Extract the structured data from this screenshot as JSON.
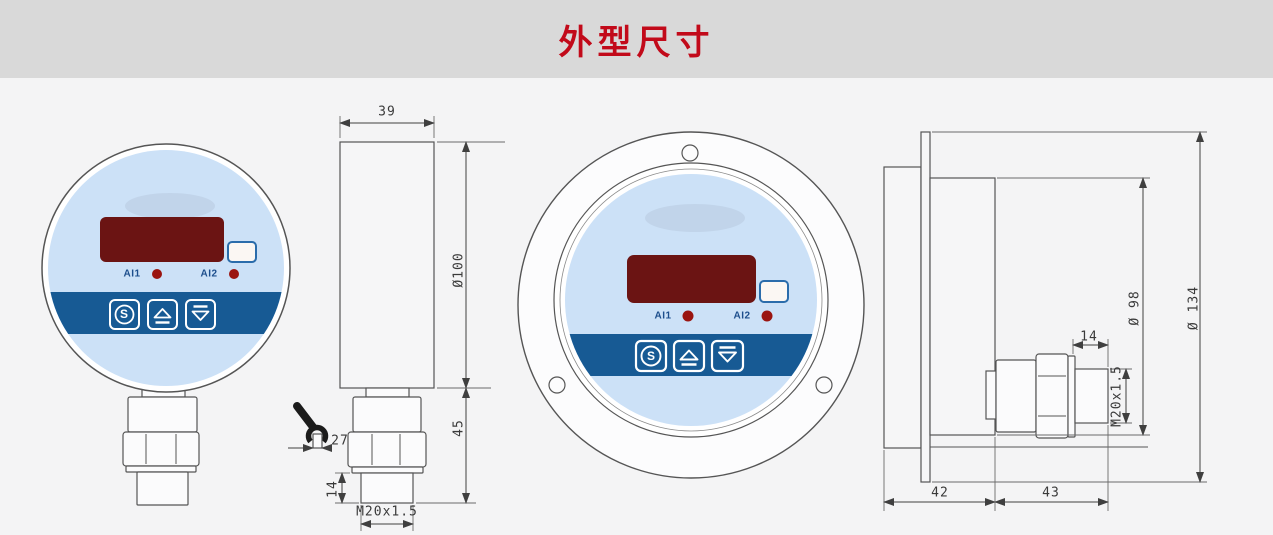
{
  "header": {
    "title": "外型尺寸"
  },
  "colors": {
    "header_bg": "#d9d9d9",
    "canvas_bg": "#f4f4f5",
    "title_red": "#c20a1a",
    "face_blue": "#cce1f7",
    "band_blue": "#175a94",
    "display_red": "#6b1413",
    "dot_red": "#9a1410",
    "label_blue": "#1d4e8c",
    "line": "#555555"
  },
  "device_face": {
    "indicator1": "AI1",
    "indicator2": "AI2",
    "set_button": "S",
    "button_icons": [
      "set-circle-s",
      "up-arrow",
      "down-arrow"
    ]
  },
  "dimensions": {
    "side_view": {
      "width": "39",
      "diameter": "Ø100",
      "wrench_size": "27",
      "lower_height": "45",
      "thread_length": "14",
      "thread_spec": "M20x1.5"
    },
    "flanged_view": {
      "thread_length": "14",
      "thread_spec": "M20x1.5",
      "body_diameter": "Ø 98",
      "flange_diameter": "Ø 134",
      "front_depth": "42",
      "rear_length": "43"
    }
  }
}
